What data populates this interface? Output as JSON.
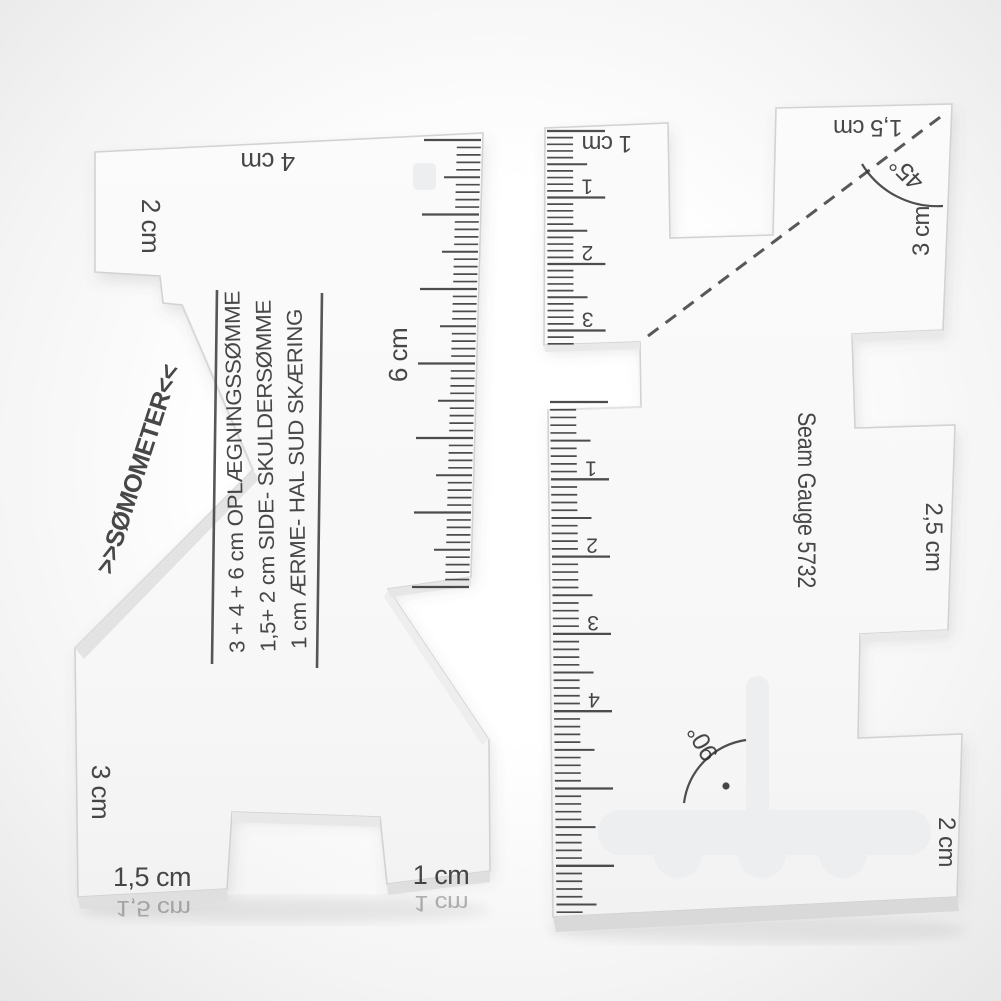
{
  "left_gauge": {
    "name_diagonal": ">>SØMOMETER<<",
    "instructions": [
      "3 + 4 + 6 cm OPLÆGNINGSSØMME",
      "1,5+ 2 cm SIDE- SKULDERSØMME",
      "1 cm ÆRME- HAL SUD SKÆRING"
    ],
    "labels": {
      "top_left": "2 cm",
      "top_center": "4 cm",
      "scale_side": "6 cm",
      "bottom_left": "3 cm",
      "bottom_tab_left": "1,5 cm",
      "bottom_tab_right": "1 cm"
    },
    "edge_reflections": {
      "left": "1,5 cm",
      "right": "1 cm"
    }
  },
  "right_gauge": {
    "model": "Seam Gauge 5732",
    "labels": {
      "top_tab": "1 cm",
      "top_right_tab": "1,5 cm",
      "angle_45": "45°",
      "edge_3cm": "3 cm",
      "tab_25": "2,5 cm",
      "angle_90": "90°",
      "bottom_2cm": "2 cm"
    },
    "scale_top_numbers": [
      "1",
      "2",
      "3"
    ],
    "scale_lower_numbers": [
      "1",
      "2",
      "3",
      "4"
    ]
  },
  "colors": {
    "background_edge": "#e7e7e7",
    "acrylic": "#f8f8f8",
    "print": "#2d2d2d"
  }
}
